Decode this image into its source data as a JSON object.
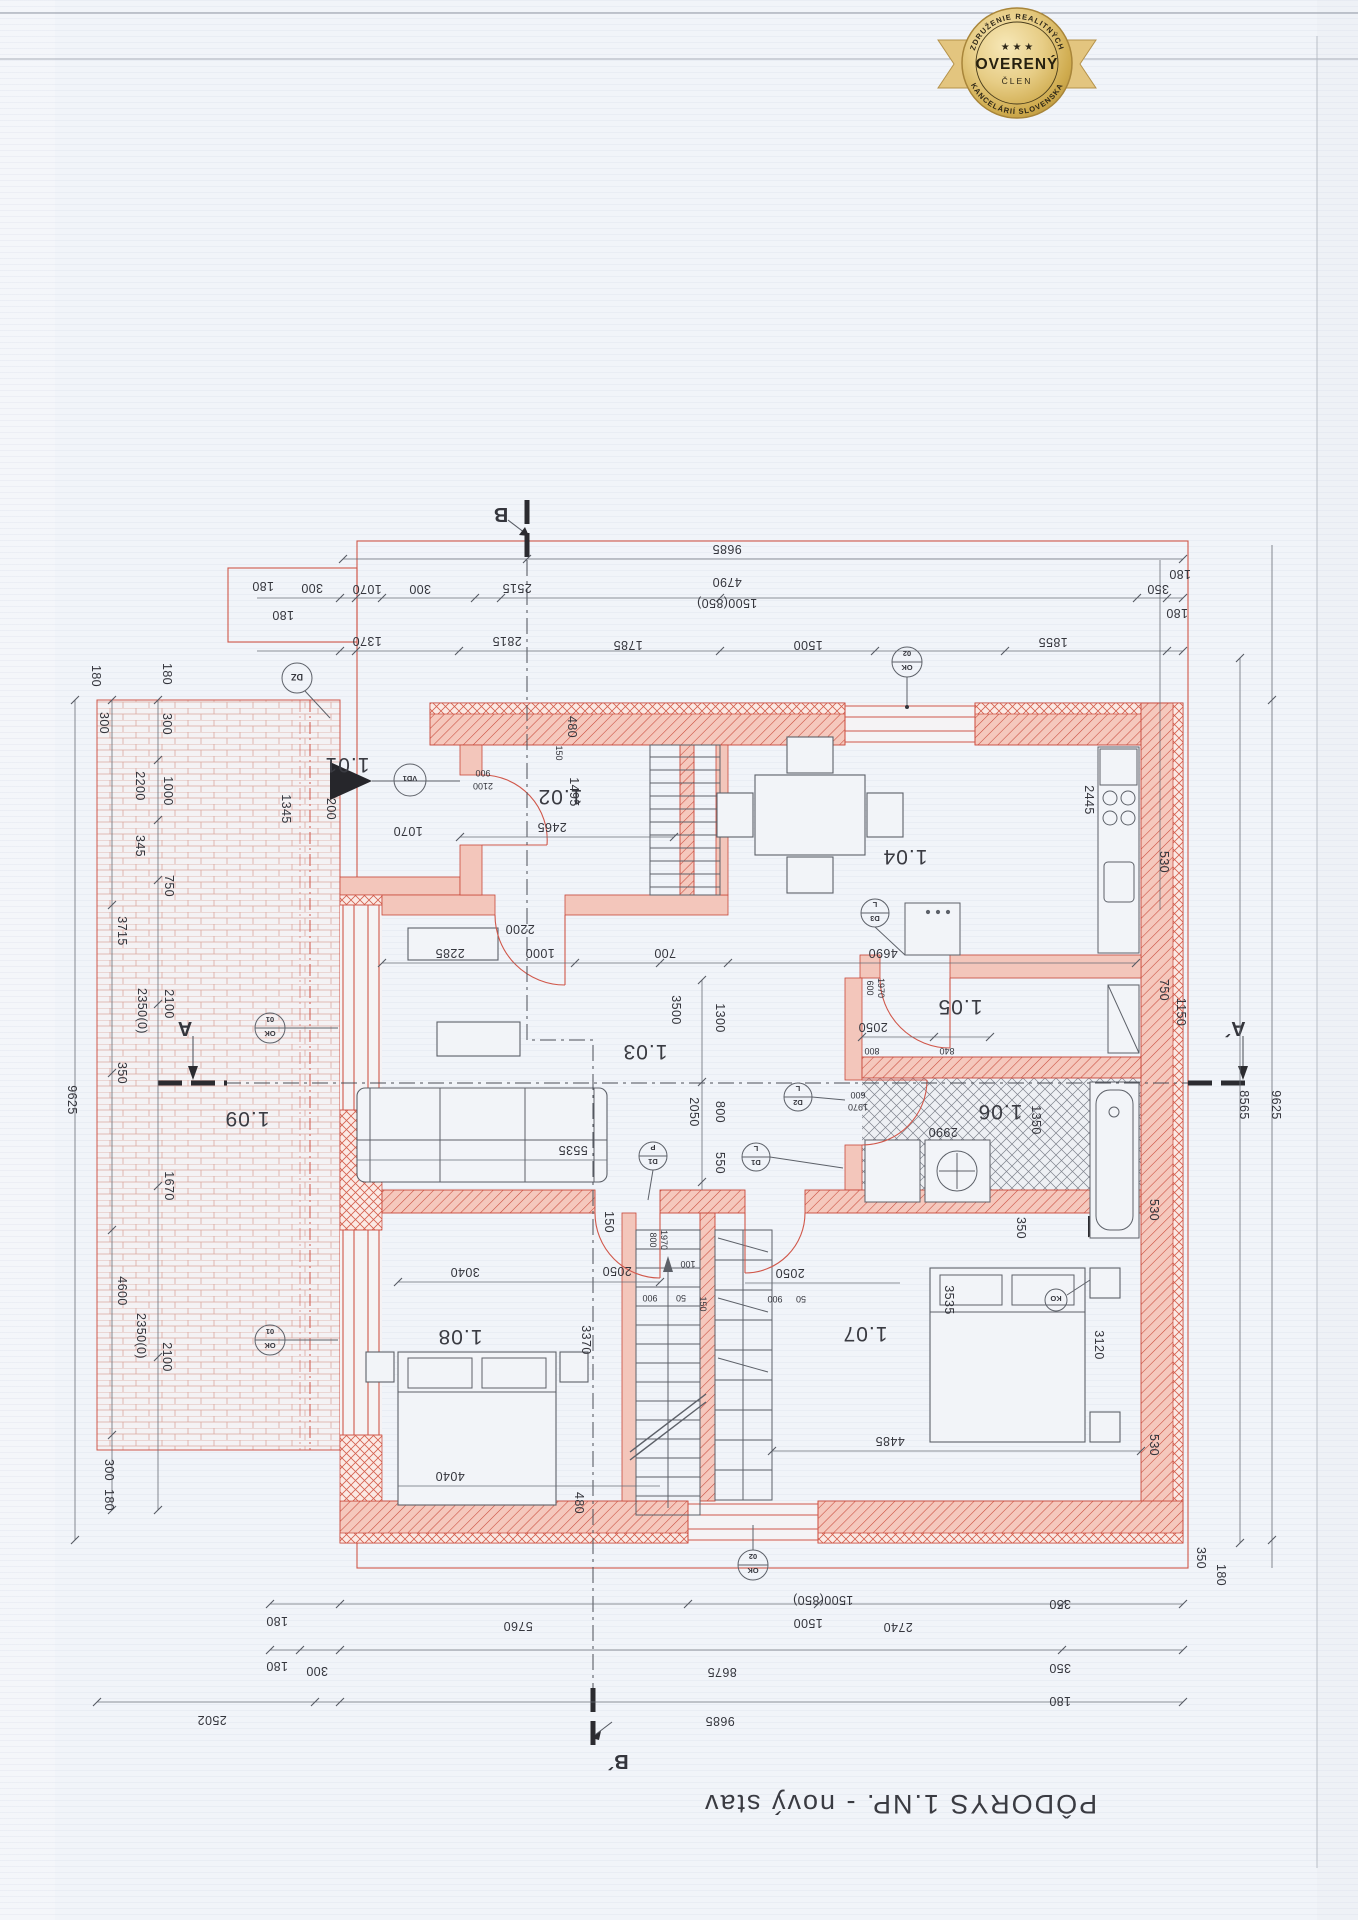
{
  "badge": {
    "arc_top": "ZDRUŽENIE REALITNÝCH",
    "stars": "★ ★ ★",
    "title": "OVERENÝ",
    "member": "ČLEN",
    "arc_bottom": "KANCELÁRIÍ SLOVENSKA"
  },
  "plan": {
    "title": "PÔDORYS 1.NP. - nový stav"
  },
  "rooms": [
    "1.01",
    "1.02",
    "1.03",
    "1.04",
    "1.05",
    "1.06",
    "1.07",
    "1.08",
    "1.09"
  ],
  "sections": {
    "b": "B",
    "bp": "B´",
    "a": "A",
    "ap": "A´"
  },
  "marks": {
    "dz": "DZ",
    "vd1": "VD1",
    "ok": "OK",
    "w01": "01",
    "w02": "02",
    "d1": "D1",
    "d2": "D2",
    "d3": "D3",
    "pl_l": "L",
    "pl_p": "P",
    "ko": "KO"
  },
  "dims": {
    "top1": [
      "9685"
    ],
    "top2": [
      "180",
      "300",
      "1070",
      "300",
      "2515",
      "4790",
      "1500(850)",
      "350",
      "180"
    ],
    "top3": [
      "180",
      "1370",
      "2815",
      "1785",
      "1500",
      "1855",
      "180"
    ],
    "bot1": [
      "180",
      "5760",
      "1500(850)",
      "1500",
      "2740",
      "350"
    ],
    "bot2": [
      "180",
      "300",
      "8675",
      "350"
    ],
    "bot3": [
      "2502",
      "9685",
      "180"
    ],
    "left": [
      "180",
      "180",
      "300",
      "300",
      "2200",
      "1000",
      "345",
      "750",
      "3715",
      "2100",
      "2350(0)",
      "350",
      "9625",
      "1670",
      "4600",
      "2350(0)",
      "2100",
      "300",
      "180"
    ],
    "right": [
      "2445",
      "530",
      "750",
      "1150",
      "1350",
      "350",
      "8565",
      "9625",
      "3120",
      "530",
      "530",
      "350",
      "180"
    ],
    "entry": [
      "2465",
      "1495",
      "150",
      "900",
      "2100",
      "1070",
      "200",
      "1345",
      "480"
    ],
    "living": [
      "2285",
      "1000",
      "700",
      "4690",
      "2200",
      "3500",
      "1300",
      "2050",
      "800",
      "550",
      "5535",
      "150"
    ],
    "doors": [
      "2050",
      "100",
      "900",
      "50",
      "800",
      "1970",
      "150",
      "2050",
      "900",
      "50"
    ],
    "bed8": [
      "3040",
      "3370",
      "4040",
      "480"
    ],
    "bed7": [
      "4485",
      "3535"
    ],
    "bath": [
      "2050",
      "800",
      "840",
      "600",
      "1970",
      "2990",
      "600",
      "1970"
    ]
  }
}
